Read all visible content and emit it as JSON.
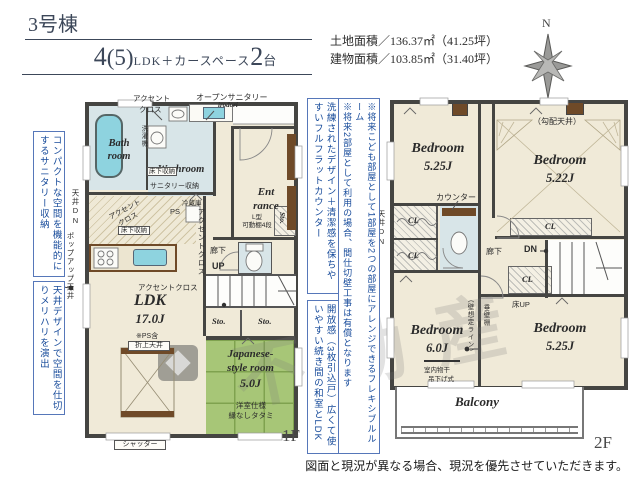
{
  "header": {
    "building_no": "3号棟",
    "plan_num1": "4",
    "plan_paren": "(5)",
    "plan_mid": "LDK＋カースペース",
    "plan_num2": "2",
    "plan_unit": "台",
    "land_area": "土地面積／136.37㎡（41.25坪）",
    "building_area": "建物面積／103.85㎡（31.40坪）",
    "compass_n": "N"
  },
  "notes": {
    "left1": "コンパクトな空間を機能的にするサニタリー収納",
    "left2": "天井デザインで空間を仕切りメリハリを演出",
    "mid1": "洗練されたデザイン＋清潔感を保ちやすいフルフラットカウンター",
    "mid2": "開放感（3枚引込戸）広くて使いやすい続き間の和室とLDK",
    "mid3_col1": "※将来こども部屋として1部屋を2つの部屋にアレンジできるフレキシブルルーム",
    "mid3_col2": "※将来2部屋として利用の場合、間仕切壁工事は有償となります"
  },
  "floor1": {
    "floor_label": "1F",
    "bath": "Bath room",
    "washroom": "Washroom",
    "entrance_l1": "Ent",
    "entrance_l2": "rance",
    "ldk_name": "LDK",
    "ldk_size": "17.0J",
    "ldk_note": "※PS含",
    "ldk_ceiling": "折上天井",
    "jp_l1": "Japanese-",
    "jp_l2": "style room",
    "jp_size": "5.0J",
    "jp_note1": "洋室仕様",
    "jp_note2": "縁なしタタミ",
    "open_sanitary": "オープンサニタリー",
    "open_sanitary_sub": "irodori",
    "accent_l1": "アクセント",
    "accent_l2": "クロス",
    "accent_full": "アクセントクロス",
    "washer": "洗濯機",
    "underfloor": "床下収納",
    "sanitary_storage": "サニタリー収納",
    "ceiling_dn": "天井DN",
    "popup_ceiling": "ポップアップ天井",
    "fridge": "冷蔵庫",
    "ps": "PS",
    "shelf_l1": "L型",
    "shelf_l2": "可動棚4段",
    "hallway": "廊下",
    "up": "UP",
    "sto": "Sto.",
    "shutter": "シャッター"
  },
  "floor2": {
    "floor_label": "2F",
    "bedroom1_name": "Bedroom",
    "bedroom1_size": "5.25J",
    "bedroom2_name": "Bedroom",
    "bedroom2_size": "5.22J",
    "bedroom3_name": "Bedroom",
    "bedroom3_size": "6.0J",
    "bedroom4_name": "Bedroom",
    "bedroom4_size": "5.25J",
    "slope_ceiling": "（勾配天井）",
    "counter": "カウンター",
    "cl": "CL",
    "ceiling_dn": "天井DN",
    "hallway": "廊下",
    "dn": "DN",
    "floor_up": "床UP",
    "hanging_wall": "垂壁棚",
    "wall_line": "（壁想定ライン）",
    "indoor_dry1": "室内物干",
    "indoor_dry2": "吊下げ式",
    "balcony": "Balcony"
  },
  "footer": {
    "disclaimer": "図面と現況が異なる場合、現況を優先させていただきます。"
  },
  "watermark": {
    "text": "不動産"
  },
  "colors": {
    "wall": "#454542",
    "room_cream": "#f0ead8",
    "room_wet": "#d8e5e8",
    "tatami_green": "#a7c677",
    "fixture_cyan": "#8ed3df",
    "wood_brown": "#6f4a28",
    "note_blue": "#164a9a",
    "header_navy": "#3c4759"
  }
}
